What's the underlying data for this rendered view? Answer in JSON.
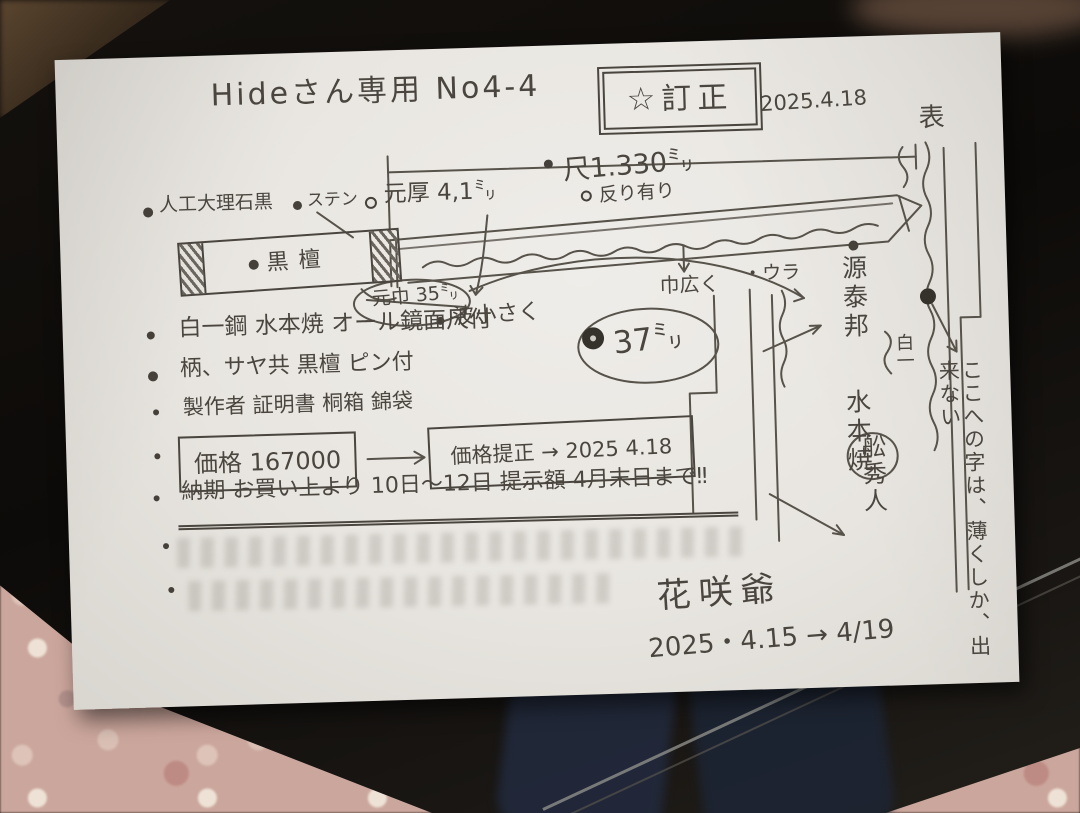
{
  "paper": {
    "title": "Hideさん専用  No4-4",
    "stamp": {
      "star": "☆",
      "label": "訂正",
      "date": "2025.4.18"
    },
    "front_label": "表",
    "ura_label": "・ウラ",
    "dims": {
      "length": "尺1.330㍉",
      "sori": "反り有り",
      "moto_atsu": "元厚 4,1㍉",
      "moto_haba_old": "元巾 35㍉",
      "moto_haba_new": "37㍉",
      "nami": "波小さく",
      "haba_hiroku": "巾広く"
    },
    "part_labels": {
      "marble": "人工大理石黒",
      "stainless": "ステン",
      "ebony": "黒檀"
    },
    "specs": [
      {
        "text": "白一鋼 水本焼 オール鏡面尺付"
      },
      {
        "text": "柄、サヤ共 黒檀 ピン付"
      },
      {
        "text": "製作者 証明書 桐箱 錦袋"
      }
    ],
    "price": {
      "current": "価格 167000",
      "revised": "価格提正 → 2025 4.18"
    },
    "delivery": "納期 お買い上より 10日〜12日 提示額 4月末日まで‼",
    "blade_side": {
      "mei": "源泰邦",
      "yaki": "水本焼",
      "steel": "白一",
      "smith": "舩秀人"
    },
    "margin_note": "ここへの字は、薄くしか、出来ない",
    "signature": {
      "name": "花咲爺",
      "date": "2025・4.15 → 4/19"
    }
  },
  "pencil_color": "#4a463f",
  "paper_color": "#e9e6e1"
}
